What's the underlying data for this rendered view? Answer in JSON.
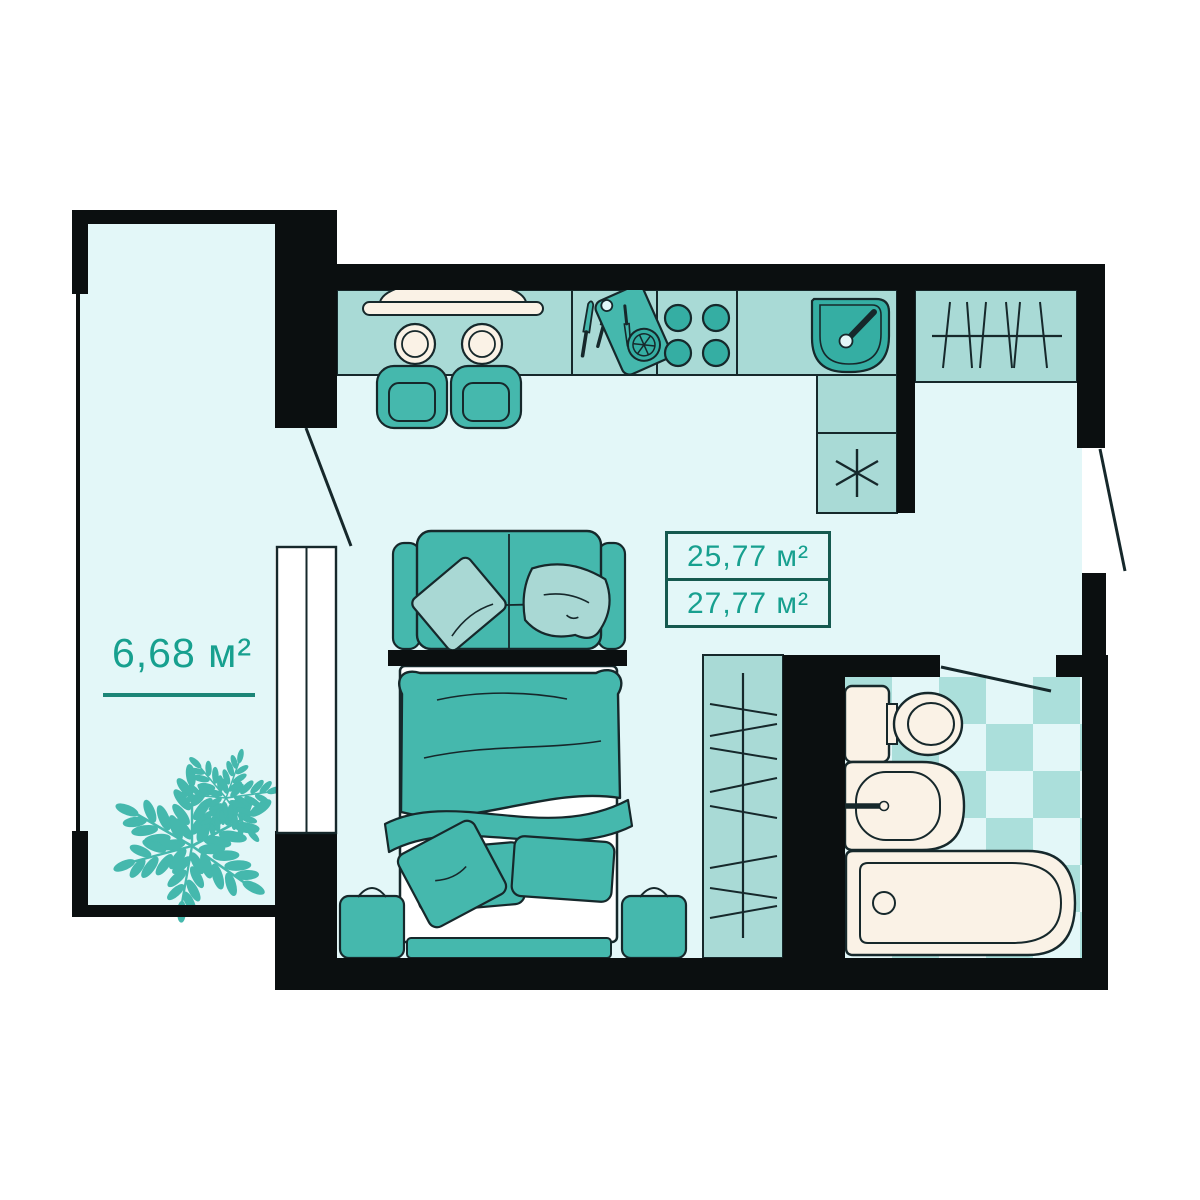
{
  "floor_plan": {
    "area_labels": {
      "balcony": "6,68 м²",
      "living_space": "25,77 м²",
      "total": "27,77 м²"
    },
    "colors": {
      "background": "#ffffff",
      "wall": "#0b0f10",
      "floor": "#e3f7f8",
      "cabinetry": "#a9dad6",
      "furniture": "#45b8ad",
      "furniture_dark": "#35aea3",
      "pillow_light": "#a9d8d4",
      "ceramic": "#faf2e6",
      "outline": "#16282b",
      "label_text": "#17a08f",
      "tile_dark": "#abdfdb",
      "tile_light": "#e3f7f8"
    },
    "rooms": [
      {
        "name": "balcony",
        "area": "6,68 м²",
        "items": [
          "plants",
          "french-window",
          "balcony-door"
        ]
      },
      {
        "name": "living-kitchen",
        "area": "25,77 м²",
        "items": [
          "dining-table",
          "two-chairs",
          "knives",
          "cutting-board",
          "stove-4-burners",
          "corner-sink",
          "washing-machine",
          "hall-wardrobe",
          "sofa",
          "double-bed",
          "two-nightstands",
          "bedroom-wardrobe",
          "entrance-door"
        ]
      },
      {
        "name": "bathroom",
        "items": [
          "toilet",
          "washbasin",
          "bathtub",
          "checker-tile-floor",
          "bathroom-door"
        ]
      }
    ]
  }
}
